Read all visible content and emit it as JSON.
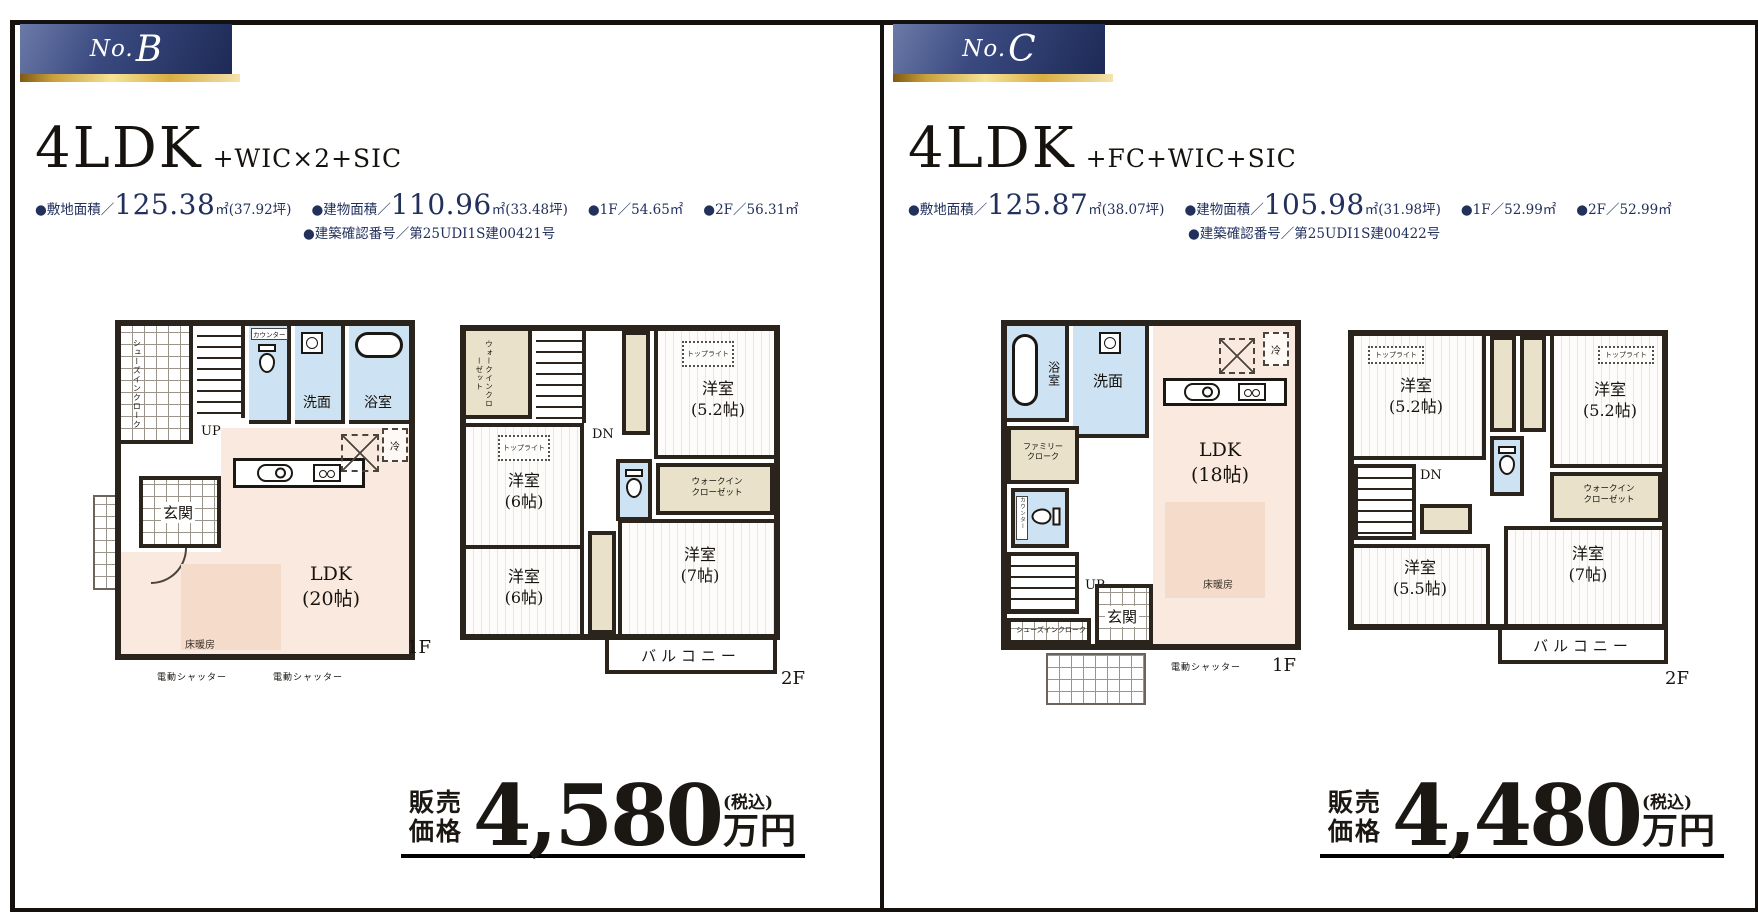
{
  "panel_b": {
    "badge_prefix": "No.",
    "badge_letter": "B",
    "plan_type": "4LDK",
    "plan_suffix": "+WIC×2+SIC",
    "spec_site_label": "●敷地面積／",
    "spec_site_big": "125.38",
    "spec_site_unit": "㎡",
    "spec_site_note": "(37.92坪)",
    "spec_bldg_label": "●建物面積／",
    "spec_bldg_big": "110.96",
    "spec_bldg_unit": "㎡",
    "spec_bldg_note": "(33.48坪)",
    "spec_1f": "●1F／54.65㎡",
    "spec_2f": "●2F／56.31㎡",
    "spec_confirm": "●建築確認番号／第25UDI1S建00421号",
    "f1": {
      "shoes": "シューズインクローク",
      "up": "UP",
      "counter": "カウンター",
      "wash": "洗面",
      "bath": "浴室",
      "genkan": "玄関",
      "fridge": "冷",
      "ldk": "LDK",
      "ldk_size": "(20帖)",
      "floor_heat": "床暖房",
      "shutter_left": "電動シャッター",
      "shutter_right": "電動シャッター",
      "tag": "1F"
    },
    "f2": {
      "wic_left": "ウォークインクローゼット",
      "dn": "DN",
      "toplight_a": "トップライト",
      "room_a": "洋室",
      "room_a_size": "(5.2帖)",
      "toplight_b": "トップライト",
      "room_b": "洋室",
      "room_b_size": "(6帖)",
      "wic_right_l1": "ウォークイン",
      "wic_right_l2": "クローゼット",
      "room_c": "洋室",
      "room_c_size": "(6帖)",
      "room_d": "洋室",
      "room_d_size": "(7帖)",
      "balcony": "バルコニー",
      "tag": "2F"
    },
    "price": {
      "label_line1": "販売",
      "label_line2": "価格",
      "value": "4,580",
      "tax": "(税込)",
      "unit": "万円"
    }
  },
  "panel_c": {
    "badge_prefix": "No.",
    "badge_letter": "C",
    "plan_type": "4LDK",
    "plan_suffix": "+FC+WIC+SIC",
    "spec_site_label": "●敷地面積／",
    "spec_site_big": "125.87",
    "spec_site_unit": "㎡",
    "spec_site_note": "(38.07坪)",
    "spec_bldg_label": "●建物面積／",
    "spec_bldg_big": "105.98",
    "spec_bldg_unit": "㎡",
    "spec_bldg_note": "(31.98坪)",
    "spec_1f": "●1F／52.99㎡",
    "spec_2f": "●2F／52.99㎡",
    "spec_confirm": "●建築確認番号／第25UDI1S建00422号",
    "f1": {
      "bath": "浴室",
      "wash": "洗面",
      "family_l1": "ファミリー",
      "family_l2": "クローク",
      "counter": "カウンター",
      "up": "UP",
      "shoes": "シューズインクローク",
      "genkan": "玄関",
      "fridge": "冷",
      "ldk": "LDK",
      "ldk_size": "(18帖)",
      "floor_heat": "床暖房",
      "shutter": "電動シャッター",
      "tag": "1F"
    },
    "f2": {
      "toplight_a": "トップライト",
      "room_a": "洋室",
      "room_a_size": "(5.2帖)",
      "toplight_b": "トップライト",
      "room_b": "洋室",
      "room_b_size": "(5.2帖)",
      "dn": "DN",
      "wic_l1": "ウォークイン",
      "wic_l2": "クローゼット",
      "room_c": "洋室",
      "room_c_size": "(5.5帖)",
      "room_d": "洋室",
      "room_d_size": "(7帖)",
      "balcony": "バルコニー",
      "tag": "2F"
    },
    "price": {
      "label_line1": "販売",
      "label_line2": "価格",
      "value": "4,480",
      "tax": "(税込)",
      "unit": "万円"
    }
  }
}
